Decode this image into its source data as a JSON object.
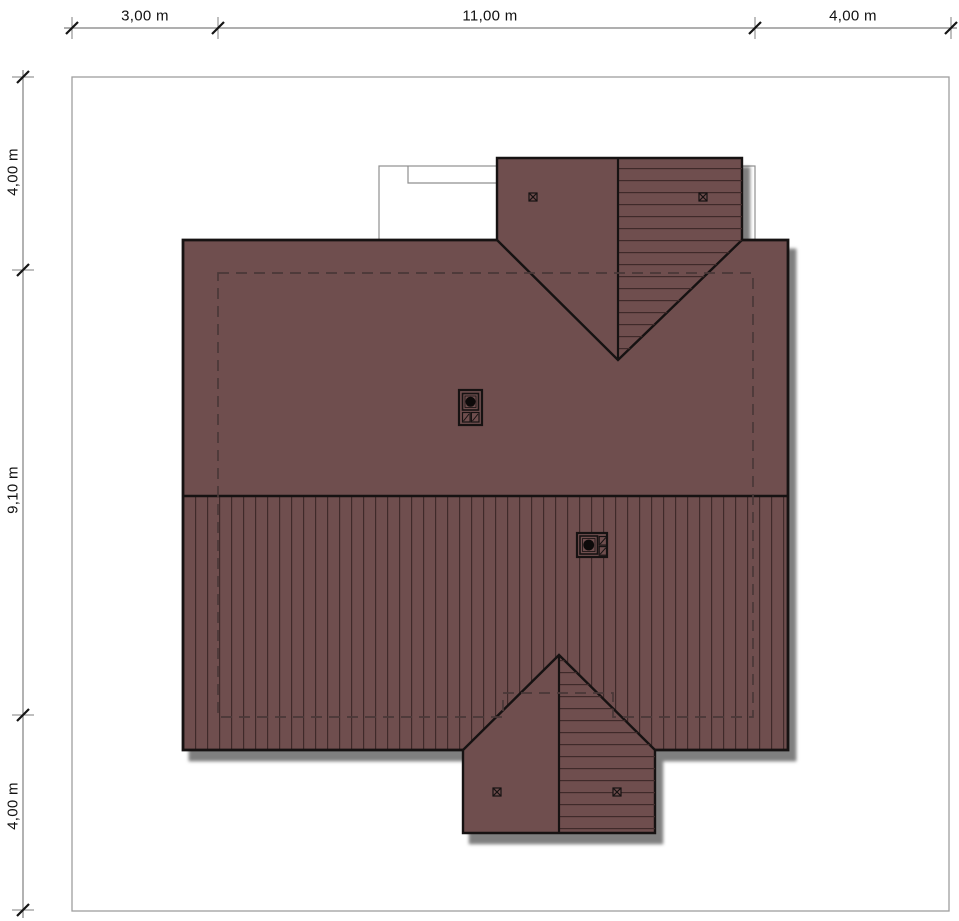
{
  "drawing": {
    "kind": "roof-plan"
  },
  "dimensions": {
    "top": {
      "labels": [
        "3,00 m",
        "11,00 m",
        "4,00 m"
      ]
    },
    "left": {
      "labels": [
        "4,00 m",
        "9,10 m",
        "4,00 m"
      ]
    }
  },
  "colors": {
    "roof": "#6f4e4e",
    "hatch": "#3f2a2a",
    "outline": "#161212",
    "dashed": "#4a3838",
    "boundary": "#9e9e9e",
    "terrace_line": "#8f8f8f",
    "dim_line": "#7f7f7f",
    "tick": "#151515",
    "text": "#111111",
    "shadow": "rgba(0,0,0,0.5)",
    "background": "#ffffff"
  }
}
